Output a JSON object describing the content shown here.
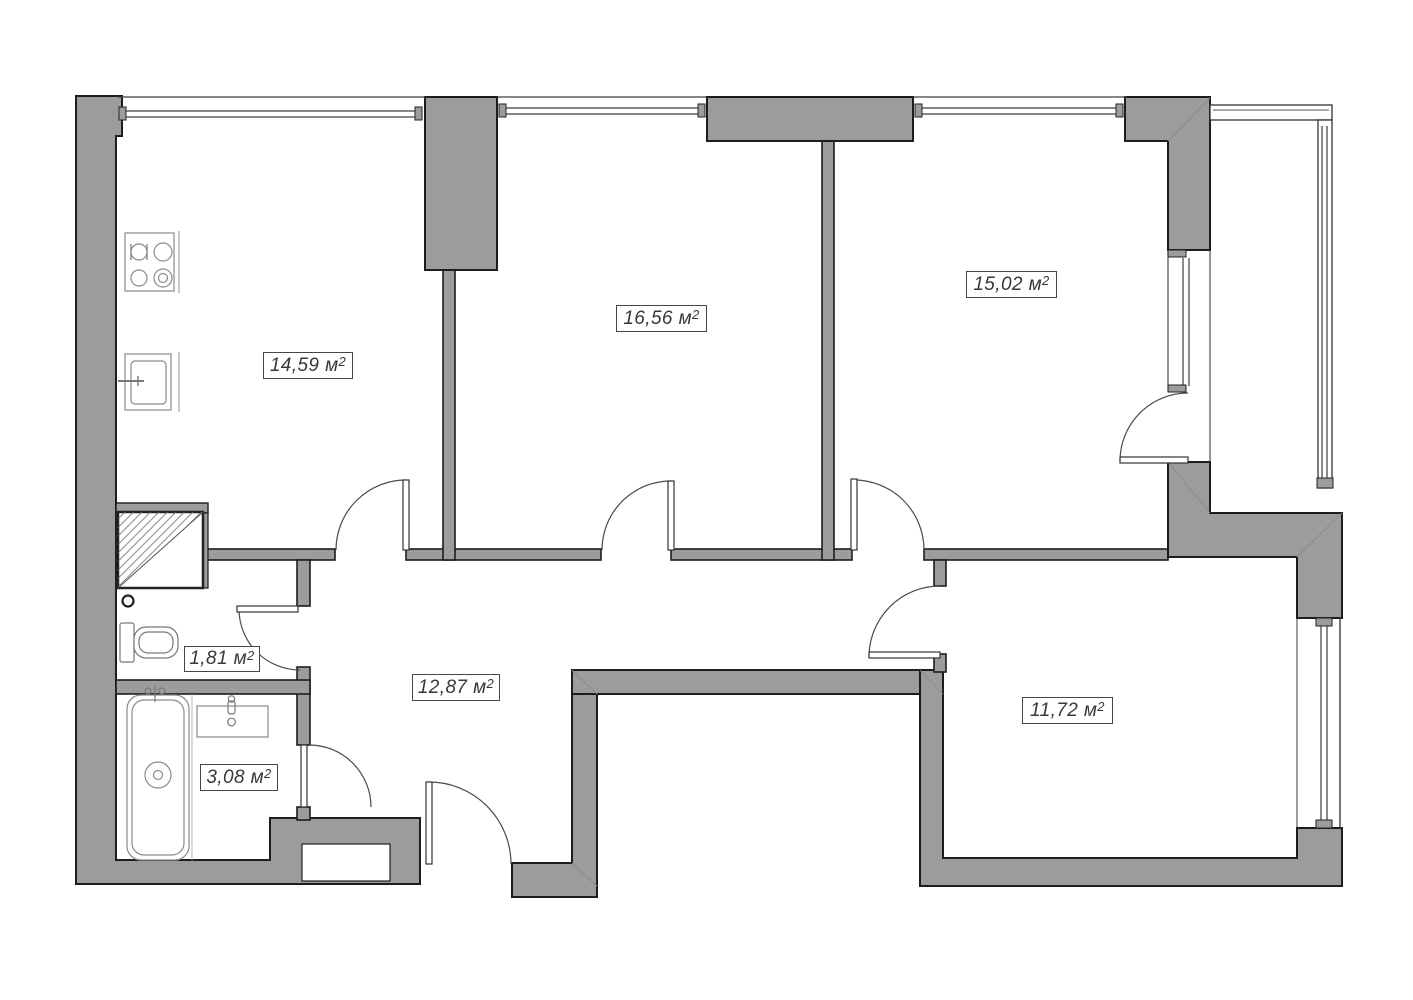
{
  "plan": {
    "areas": [
      {
        "room": "kitchen",
        "value": "14,59"
      },
      {
        "room": "room-top-middle",
        "value": "16,56"
      },
      {
        "room": "room-top-right",
        "value": "15,02"
      },
      {
        "room": "wc",
        "value": "1,81"
      },
      {
        "room": "hallway",
        "value": "12,87"
      },
      {
        "room": "bathroom",
        "value": "3,08"
      },
      {
        "room": "room-bottom-right",
        "value": "11,72"
      }
    ],
    "units": {
      "m": " м",
      "sup": "2"
    },
    "colors": {
      "wall_fill": "#9c9c9c",
      "wall_outline": "#1d1d1d",
      "thin_line": "#474747",
      "fixture_line": "#8a8a8a",
      "label_border": "#454545",
      "text": "#383838",
      "background": "#ffffff"
    }
  }
}
